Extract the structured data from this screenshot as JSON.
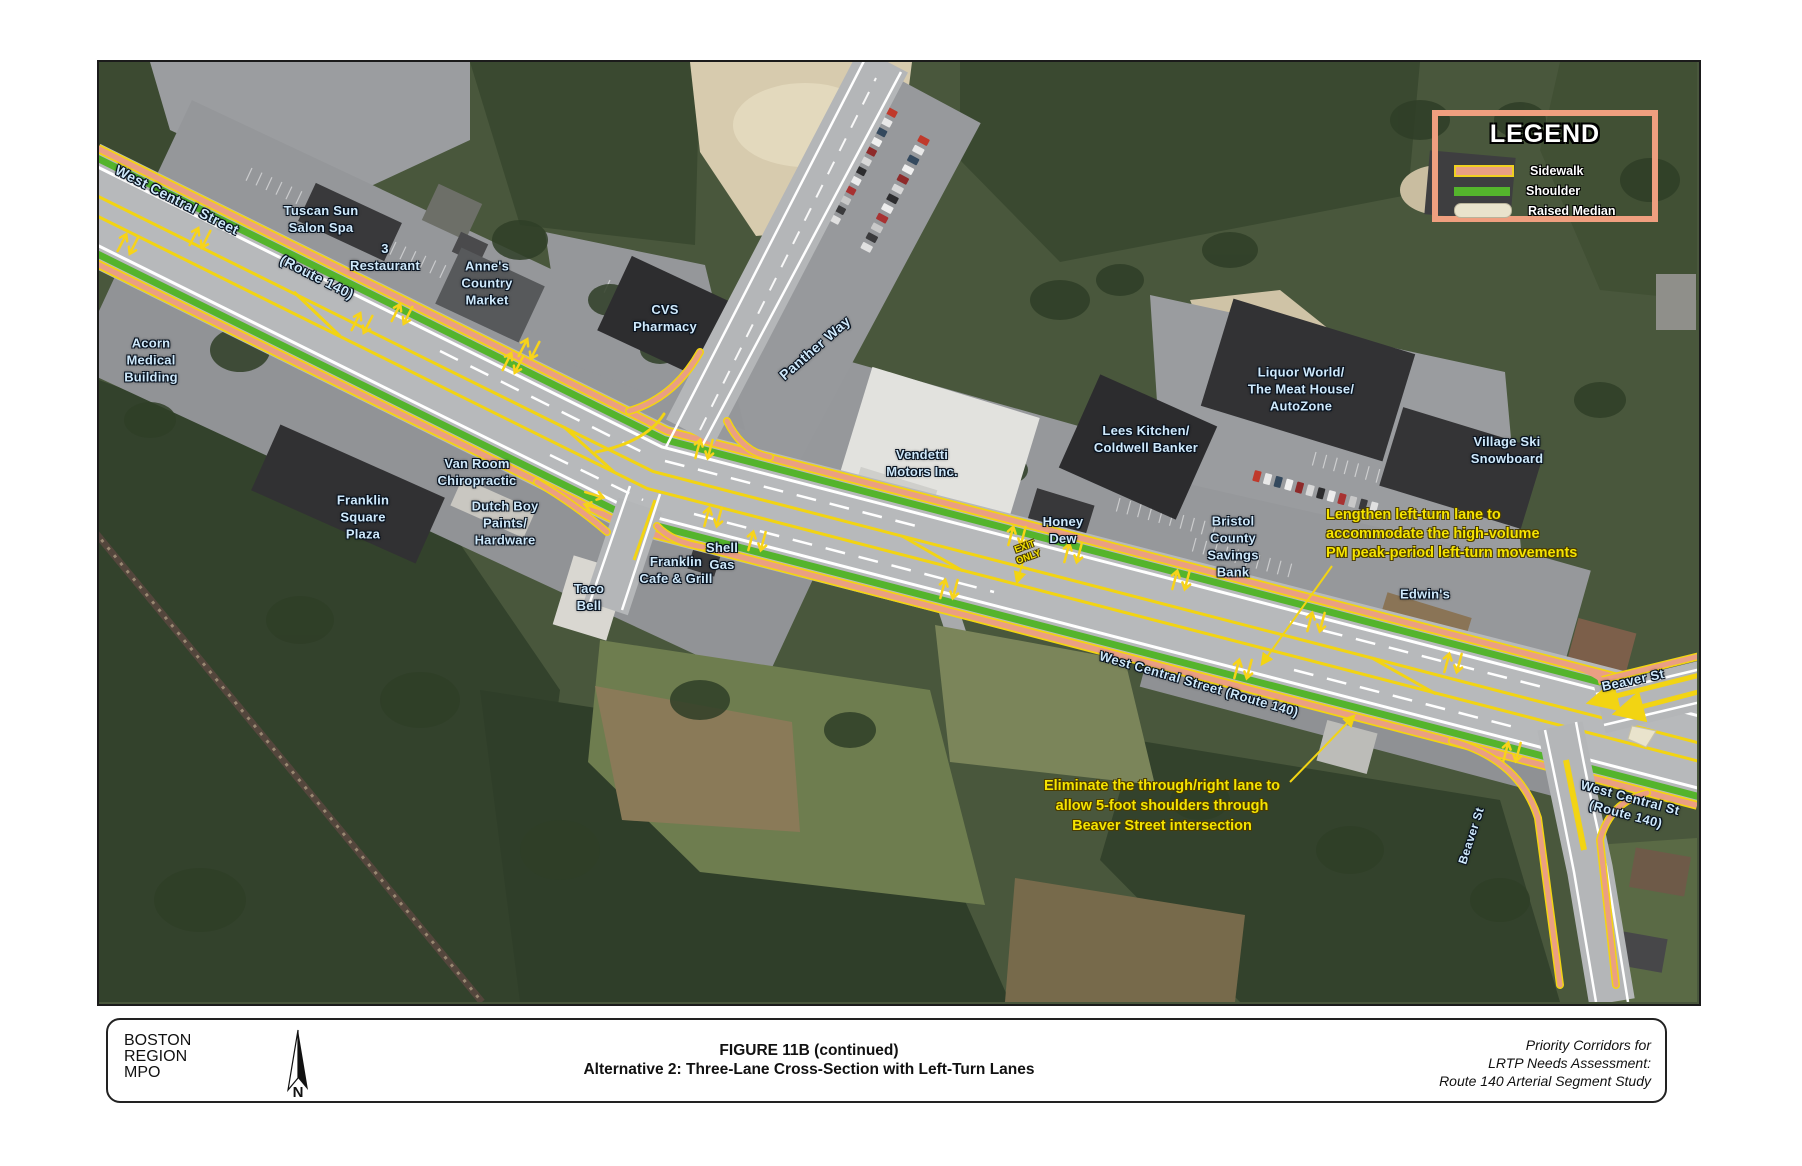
{
  "map": {
    "road_labels": {
      "west_central_top": "West Central Street",
      "route_140_top": "(Route 140)",
      "panther_way": "Panther Way",
      "west_central_mid": "West Central Street (Route 140)",
      "beaver_ne": "Beaver St",
      "west_central_right": "West Central St\n(Route 140)",
      "beaver_s": "Beaver St"
    },
    "place_labels": {
      "tuscan_sun": "Tuscan Sun\nSalon Spa",
      "restaurant": "3\nRestaurant",
      "acorn": "Acorn\nMedical\nBuilding",
      "annes": "Anne's\nCountry\nMarket",
      "cvs": "CVS\nPharmacy",
      "vendetti": "Vendetti\nMotors Inc.",
      "franklin_square": "Franklin\nSquare\nPlaza",
      "van_room": "Van Room\nChiropractic",
      "dutch_boy": "Dutch Boy\nPaints/\nHardware",
      "taco_bell": "Taco\nBell",
      "franklin_cafe": "Franklin\nCafe & Grill",
      "shell": "Shell\nGas",
      "honey_dew": "Honey\nDew",
      "lees": "Lees Kitchen/\nColdwell Banker",
      "bristol": "Bristol\nCounty\nSavings\nBank",
      "liquor": "Liquor World/\nThe Meat House/\nAutoZone",
      "village": "Village Ski\nSnowboard",
      "edwins": "Edwin's"
    },
    "annotations": {
      "lengthen": "Lengthen left-turn lane to\naccommodate the high-volume\nPM peak-period left-turn movements",
      "eliminate": "Eliminate the through/right lane to\nallow 5-foot shoulders through\nBeaver Street intersection",
      "exit_only": "EXIT\nONLY"
    }
  },
  "legend": {
    "title": "LEGEND",
    "items": [
      {
        "label": "Sidewalk"
      },
      {
        "label": "Shoulder"
      },
      {
        "label": "Raised Median"
      }
    ]
  },
  "footer": {
    "agency": "BOSTON\nREGION\nMPO",
    "compass": "N",
    "figure": "FIGURE 11B (continued)",
    "subtitle": "Alternative 2: Three-Lane Cross-Section with Left-Turn Lanes",
    "project": "Priority Corridors for\nLRTP Needs Assessment:\nRoute 140 Arterial Segment Study"
  },
  "colors": {
    "sidewalk": "#ea9f83",
    "shoulder": "#54b42c",
    "raised_median": "#e9e3cc",
    "annotation_yellow": "#f6e400",
    "label_blue": "#cfe9fb"
  }
}
